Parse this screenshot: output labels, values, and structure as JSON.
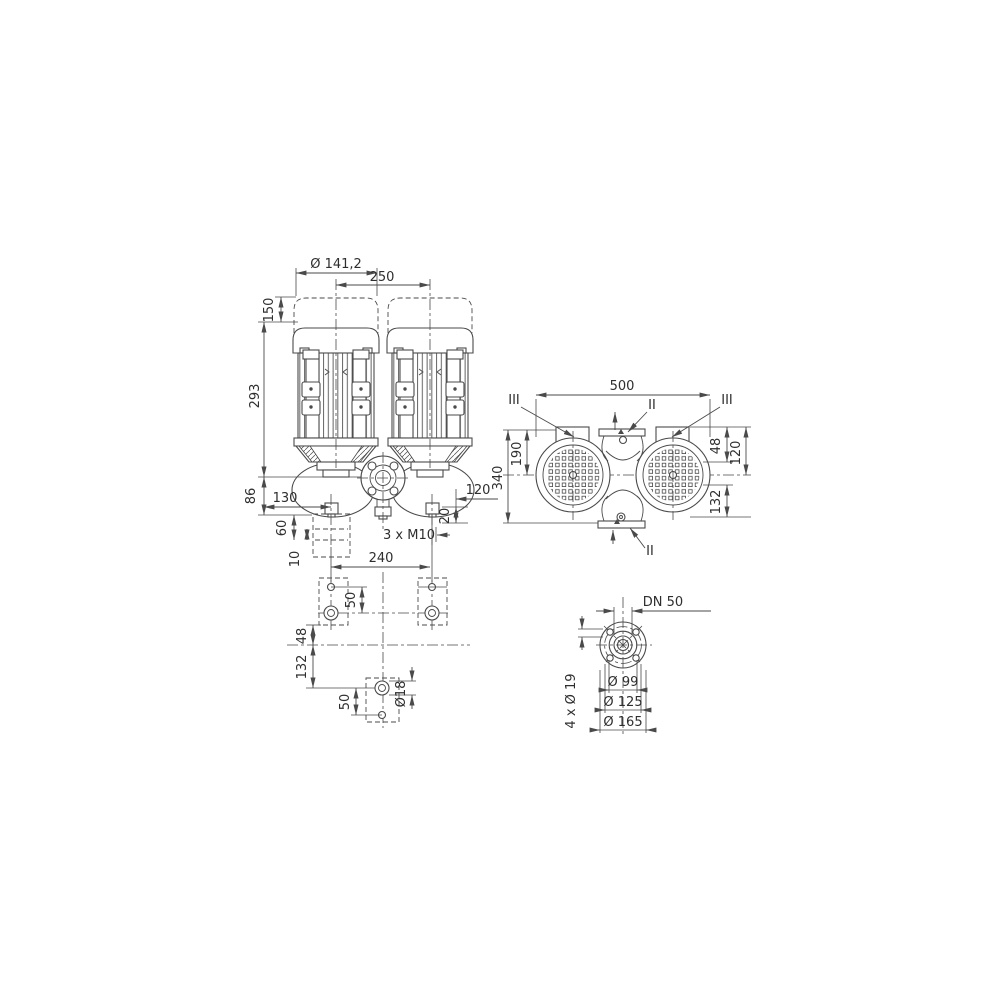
{
  "drawing": {
    "front_view": {
      "motor_diameter": "Ø 141,2",
      "axis_spacing": "250",
      "removal_clearance": "150",
      "motor_height": "293",
      "base_height": "86",
      "drain_offset_left": "130",
      "drain_offset_right": "120",
      "plug_offset": "20",
      "thread_label": "3 x M10",
      "foot_height": "60",
      "shim_height": "10",
      "anchor_spacing": "240"
    },
    "side_view": {
      "overall_width": "500",
      "overall_height": "340",
      "upper_height": "190",
      "offset_upper": "48",
      "port_height": "120",
      "offset_lower": "132",
      "section_marker_left": "III",
      "section_marker_right": "III",
      "section_marker_top": "II",
      "section_marker_bottom": "II"
    },
    "plan_view": {
      "hole_offset_top": "50",
      "row_offset_upper": "48",
      "row_offset_lower": "132",
      "hole_offset_bottom": "50",
      "hole_diameter": "Ø18"
    },
    "flange_view": {
      "nominal_diameter": "DN 50",
      "raised_face": "Ø 99",
      "bolt_circle": "Ø 125",
      "outer_diameter": "Ø 165",
      "bolt_holes": "4 x Ø 19"
    }
  }
}
